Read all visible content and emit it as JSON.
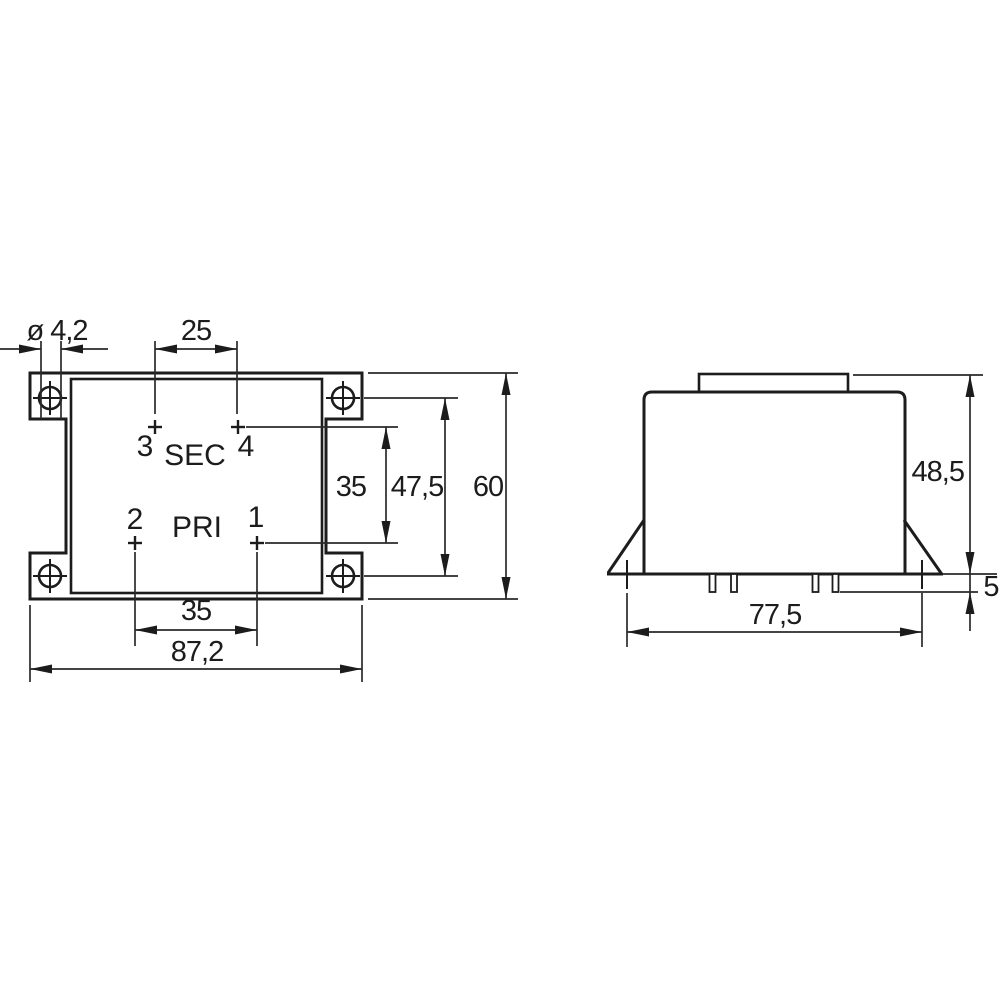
{
  "meta": {
    "kind": "technical dimension drawing",
    "subject": "PCB-mount transformer outline, top view and front view, millimetre dimensions",
    "ink_color": "#1c1c1c",
    "background_color": "#ffffff"
  },
  "top_view": {
    "pins": {
      "p1": "1",
      "p2": "2",
      "p3": "3",
      "p4": "4"
    },
    "windings": {
      "sec": "SEC",
      "pri": "PRI"
    },
    "dims": {
      "hole_diameter": "ø 4,2",
      "sec_pin_pitch": "25",
      "row_pitch": "35",
      "hole_pitch_vertical": "47,5",
      "overall_height": "60",
      "pri_pin_pitch": "35",
      "overall_width": "87,2"
    }
  },
  "front_view": {
    "dims": {
      "overall_height": "48,5",
      "pin_length": "5",
      "mounting_hole_pitch": "77,5"
    }
  }
}
